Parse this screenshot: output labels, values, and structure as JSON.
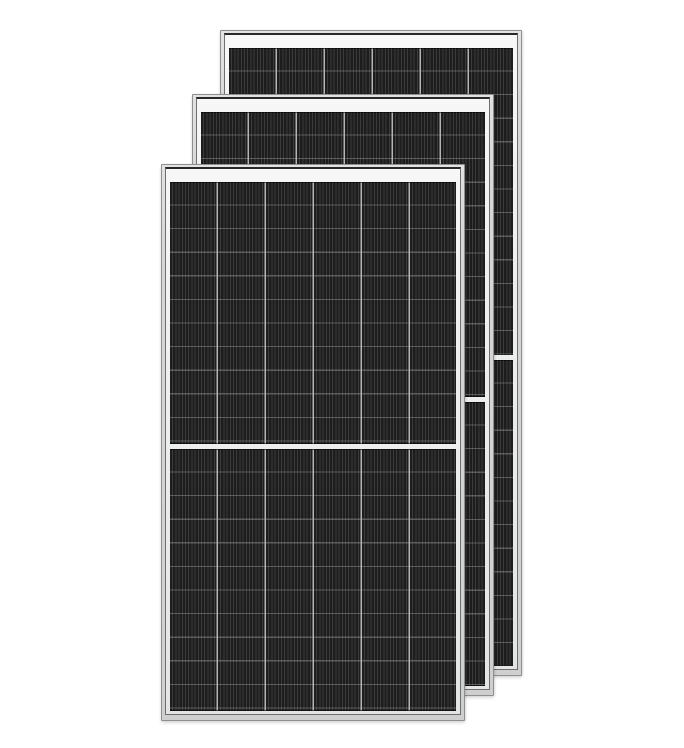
{
  "image": {
    "subject": "Product render of three overlapping black monocrystalline half-cut solar PV panels with silver aluminum frames on a plain white background",
    "panel_count": 3,
    "visible_text": ""
  },
  "colors": {
    "background": "#ffffff",
    "frame": "#d7d7d7",
    "frame_edge": "#8f8f8f",
    "frame_dark_line": "#282828",
    "inner_side_line": "#6e6e6e",
    "backsheet_white": "#f0f0f0",
    "cell_dark": "#1d1d1d",
    "cell_stripe": "#3b3b3b",
    "row_line": "rgba(220,220,220,0.30)",
    "column_divider": "#b5b5b5"
  },
  "panels": [
    {
      "name": "back",
      "x": 220,
      "y": 30,
      "width": 302,
      "height": 646,
      "z": 1,
      "columns": 6,
      "rows_per_half": 13
    },
    {
      "name": "middle",
      "x": 192,
      "y": 94,
      "width": 302,
      "height": 602,
      "z": 2,
      "columns": 6,
      "rows_per_half": 12
    },
    {
      "name": "front",
      "x": 161,
      "y": 164,
      "width": 304,
      "height": 557,
      "z": 3,
      "columns": 6,
      "rows_per_half": 11
    }
  ],
  "panel_features": {
    "top_backsheet_strip": true,
    "center_split_gap": true,
    "half_cell_design": true
  }
}
